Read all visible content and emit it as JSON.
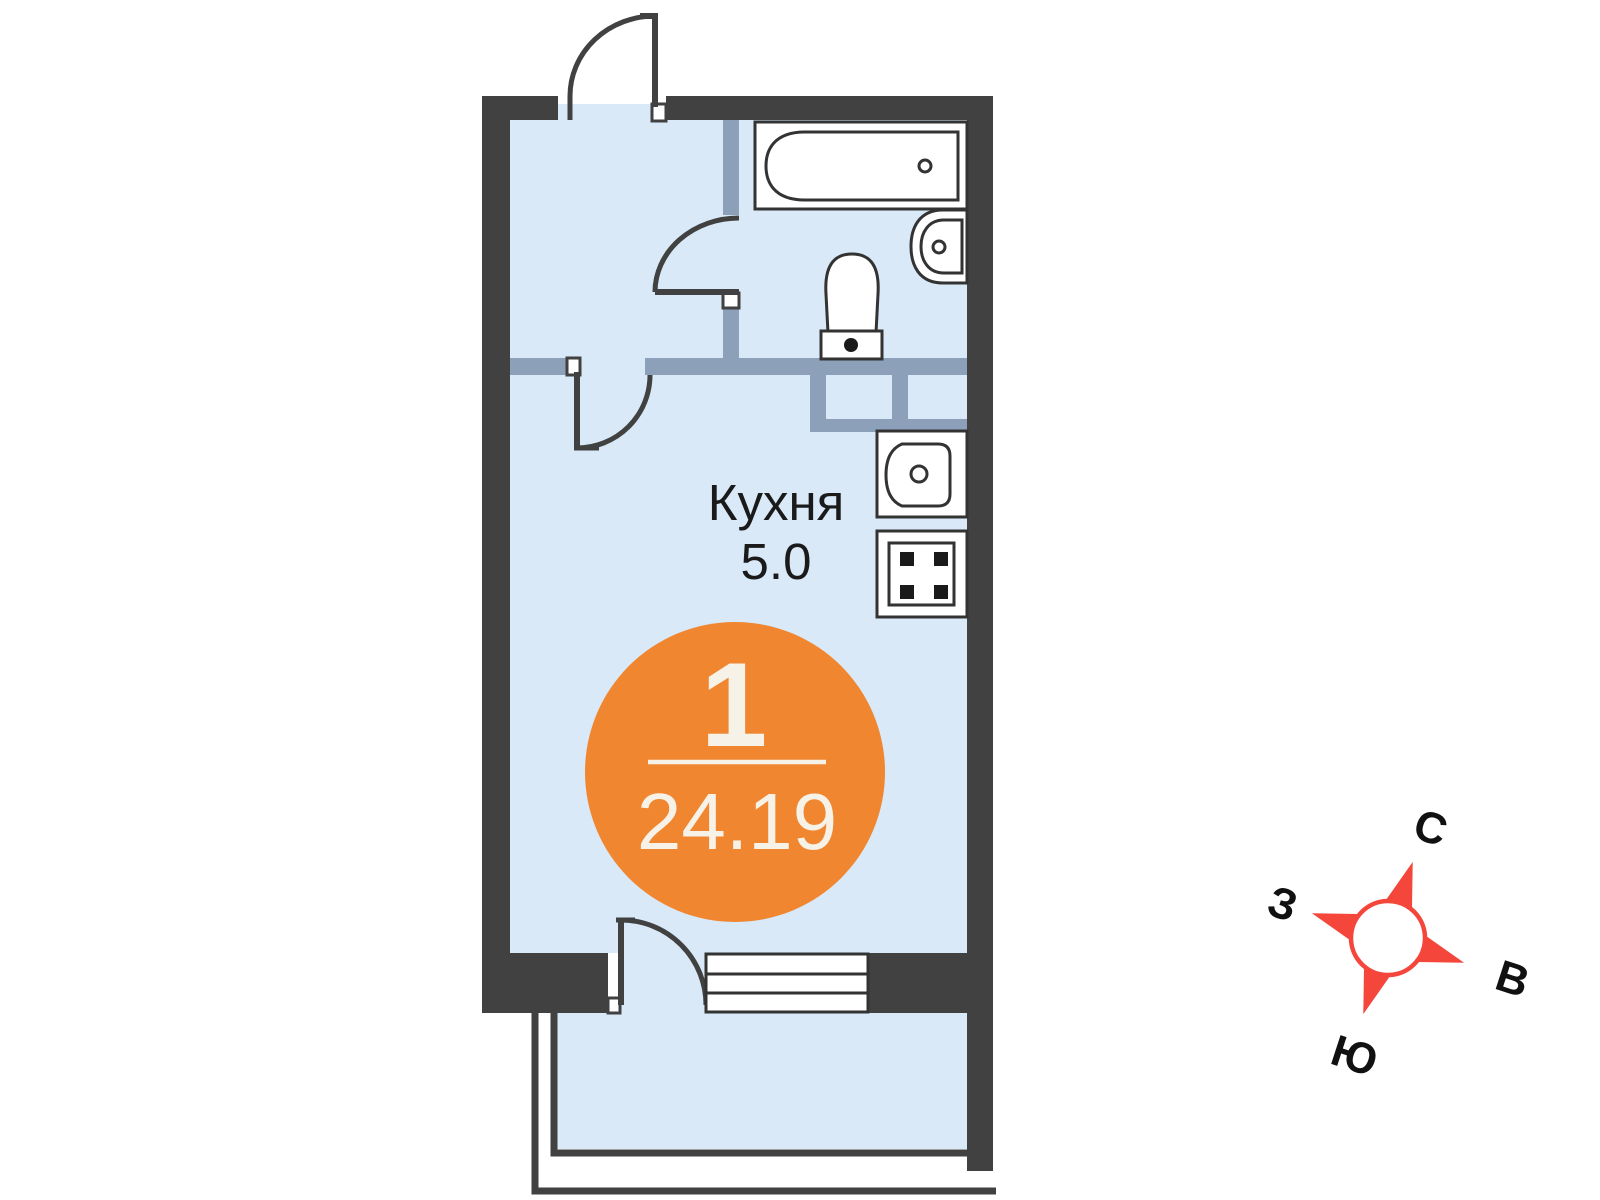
{
  "kitchen": {
    "label": "Кухня",
    "area": "5.0"
  },
  "badge": {
    "rooms": "1",
    "area": "24.19"
  },
  "compass": {
    "north": "С",
    "east": "В",
    "south": "Ю",
    "west": "З"
  },
  "colors": {
    "wall": "#414141",
    "partition": "#8CA0B9",
    "floor": "#D9E9F8",
    "fixture_outline": "#333333",
    "badge_orange": "#F0862F",
    "badge_text": "#F7F2E7",
    "compass_red": "#F4463A",
    "label_text": "#1A1A1A",
    "background": "#FFFFFF"
  }
}
